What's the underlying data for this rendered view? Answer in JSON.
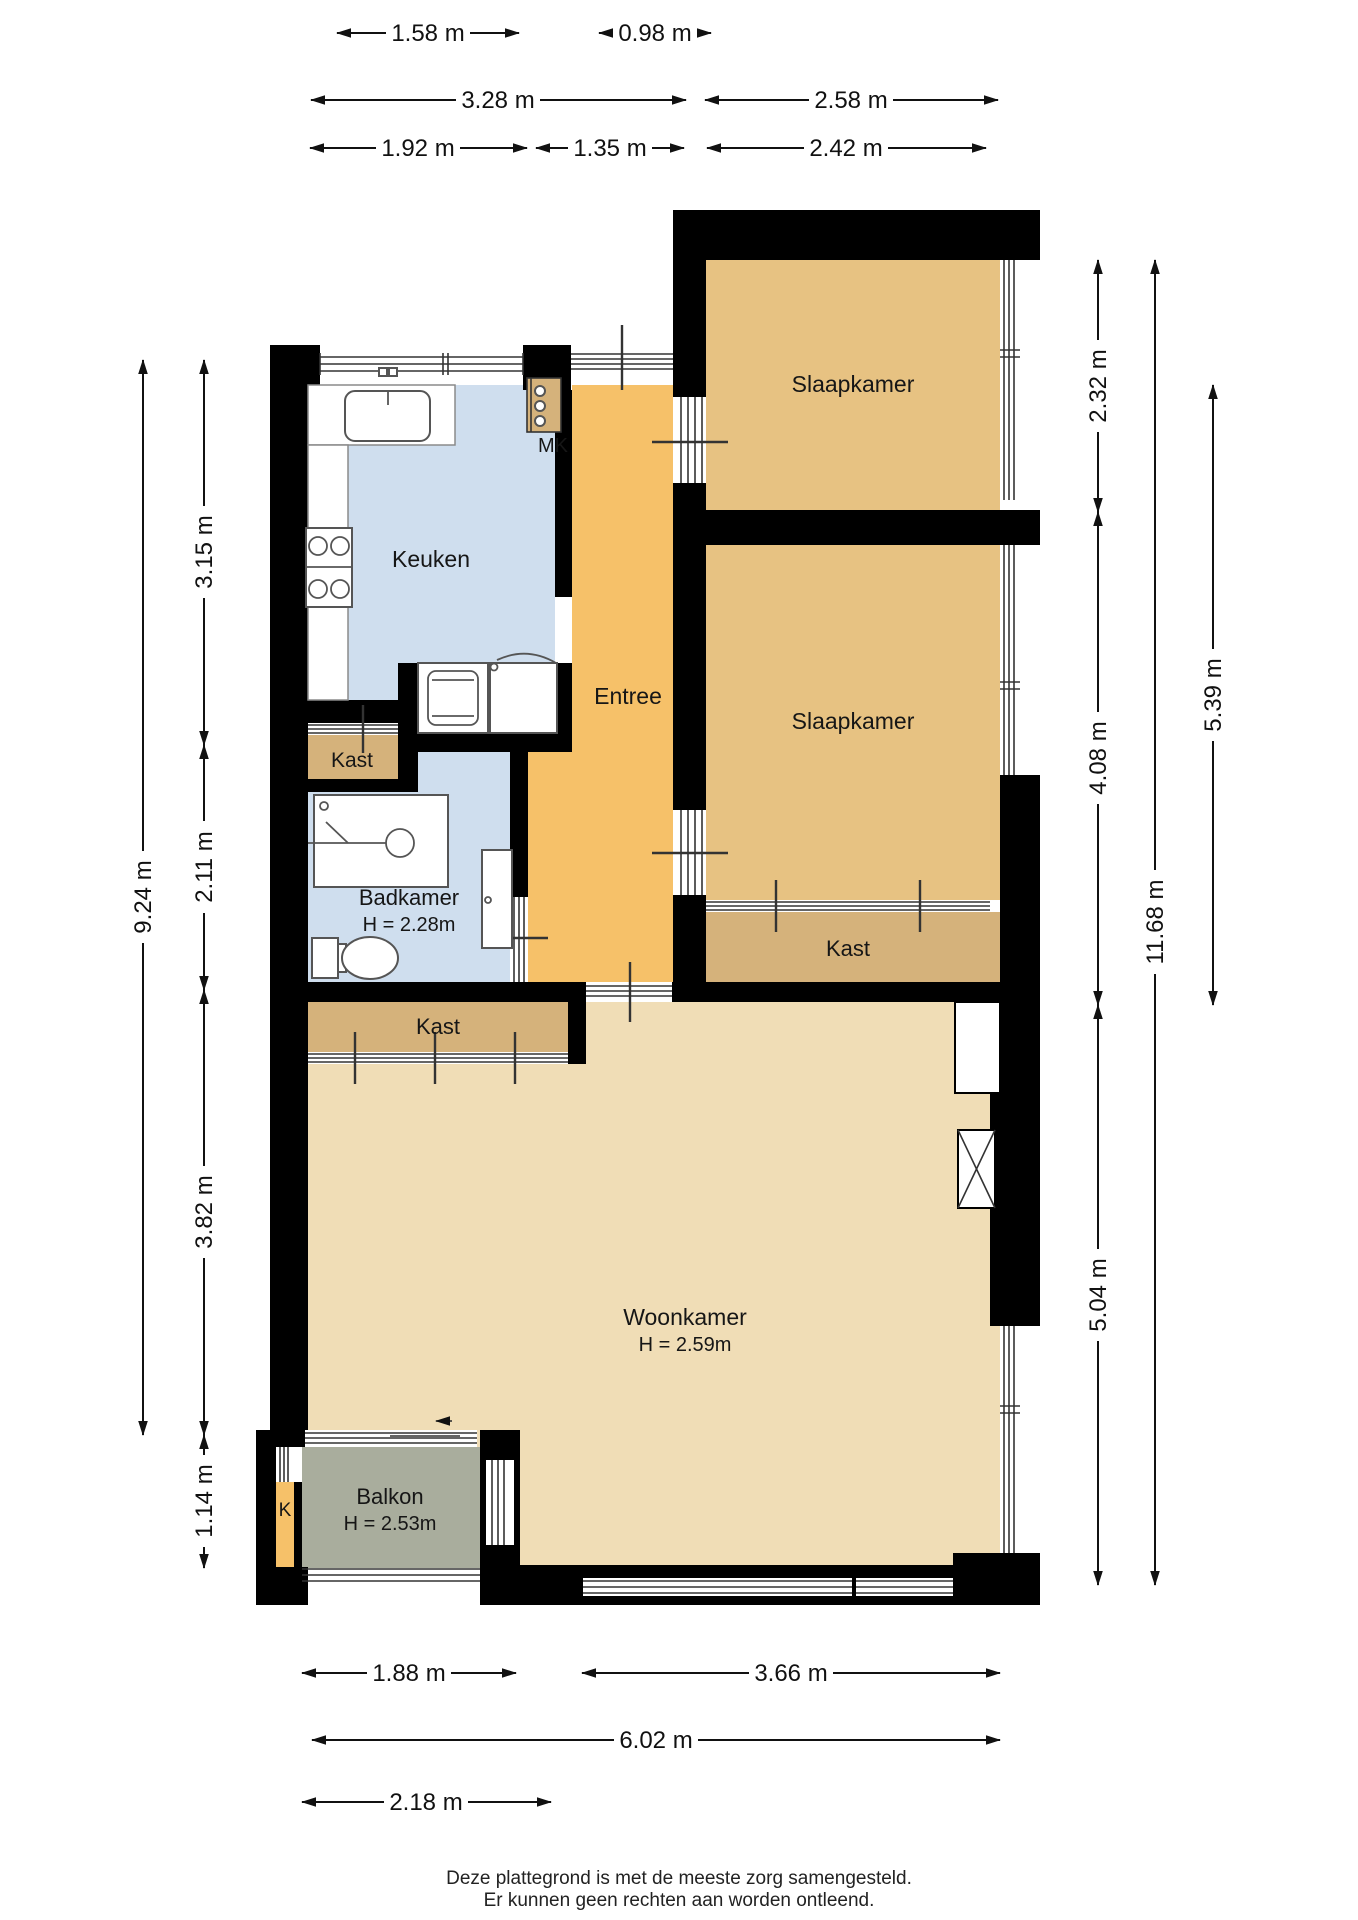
{
  "colors": {
    "wall": "#000000",
    "bedroom": "#e7c282",
    "entree": "#f6c169",
    "closet": "#d5b27b",
    "living": "#f0ddb6",
    "wet": "#cfdeee",
    "balcony": "#a9ad9d"
  },
  "rooms": {
    "slaapkamer_1": {
      "label": "Slaapkamer"
    },
    "slaapkamer_2": {
      "label": "Slaapkamer"
    },
    "entree": {
      "label": "Entree"
    },
    "keuken": {
      "label": "Keuken"
    },
    "badkamer": {
      "label": "Badkamer",
      "ceiling_height": "H = 2.28m"
    },
    "woonkamer": {
      "label": "Woonkamer",
      "ceiling_height": "H = 2.59m"
    },
    "balkon": {
      "label": "Balkon",
      "ceiling_height": "H = 2.53m"
    },
    "kast_keuken": {
      "label": "Kast"
    },
    "kast_slaapkamer": {
      "label": "Kast"
    },
    "kast_woonkamer": {
      "label": "Kast"
    },
    "meterkast": {
      "label": "MK"
    },
    "koof": {
      "label": "K"
    }
  },
  "dimensions": {
    "top_row1": [
      {
        "label": "1.58 m"
      },
      {
        "label": "0.98 m"
      }
    ],
    "top_row2": [
      {
        "label": "3.28 m"
      },
      {
        "label": "2.58 m"
      }
    ],
    "top_row3": [
      {
        "label": "1.92 m"
      },
      {
        "label": "1.35 m"
      },
      {
        "label": "2.42 m"
      }
    ],
    "left_outer": [
      {
        "label": "9.24 m"
      }
    ],
    "left_inner": [
      {
        "label": "3.15 m"
      },
      {
        "label": "2.11 m"
      },
      {
        "label": "3.82 m"
      },
      {
        "label": "1.14 m"
      }
    ],
    "right_inner": [
      {
        "label": "2.32 m"
      },
      {
        "label": "4.08 m"
      },
      {
        "label": "5.04 m"
      }
    ],
    "right_middle": [
      {
        "label": "11.68 m"
      }
    ],
    "right_outer": [
      {
        "label": "5.39 m"
      }
    ],
    "bottom_row1": [
      {
        "label": "1.88 m"
      },
      {
        "label": "3.66 m"
      }
    ],
    "bottom_row2": [
      {
        "label": "6.02 m"
      }
    ],
    "bottom_row3": [
      {
        "label": "2.18 m"
      }
    ]
  },
  "footer": {
    "line1": "Deze plattegrond is met de meeste zorg samengesteld.",
    "line2": "Er kunnen geen rechten aan worden ontleend."
  }
}
